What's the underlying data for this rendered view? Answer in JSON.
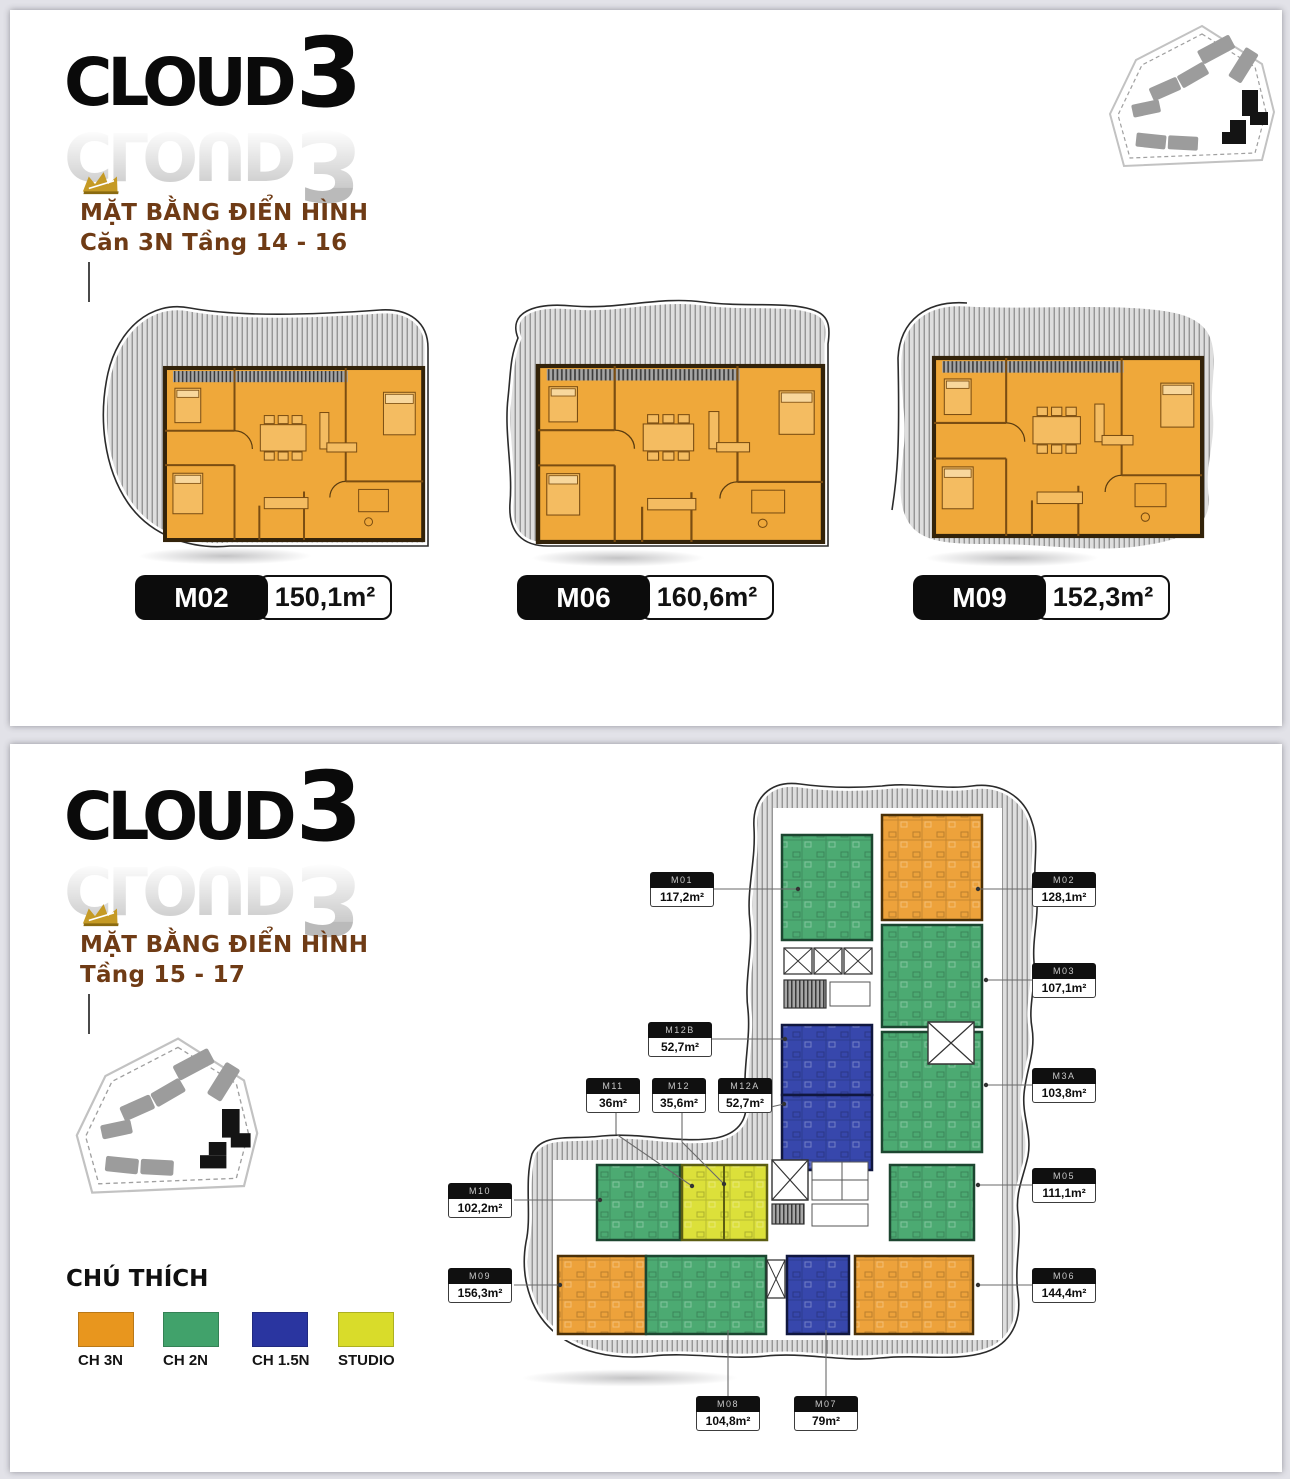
{
  "logo": {
    "word": "CLOUD",
    "digit": "3"
  },
  "top_panel": {
    "title_line1": "MẶT BẰNG ĐIỂN HÌNH",
    "title_line2": "Căn 3N Tầng 14 - 16",
    "plans": [
      {
        "id": "M02",
        "area": "150,1m²"
      },
      {
        "id": "M06",
        "area": "160,6m²"
      },
      {
        "id": "M09",
        "area": "152,3m²"
      }
    ]
  },
  "bottom_panel": {
    "title_line1": "MẶT BẰNG ĐIỂN HÌNH",
    "title_line2": "Tầng 15 - 17",
    "legend": {
      "title": "CHÚ THÍCH",
      "items": [
        {
          "label": "CH 3N",
          "color": "#E8961E"
        },
        {
          "label": "CH 2N",
          "color": "#41A26B"
        },
        {
          "label": "CH 1.5N",
          "color": "#2A35A0"
        },
        {
          "label": "STUDIO",
          "color": "#D9DC2A"
        }
      ]
    },
    "units": [
      {
        "id": "M01",
        "area": "117,2m²"
      },
      {
        "id": "M02",
        "area": "128,1m²"
      },
      {
        "id": "M03",
        "area": "107,1m²"
      },
      {
        "id": "M3A",
        "area": "103,8m²"
      },
      {
        "id": "M05",
        "area": "111,1m²"
      },
      {
        "id": "M06",
        "area": "144,4m²"
      },
      {
        "id": "M12B",
        "area": "52,7m²"
      },
      {
        "id": "M11",
        "area": "36m²"
      },
      {
        "id": "M12",
        "area": "35,6m²"
      },
      {
        "id": "M12A",
        "area": "52,7m²"
      },
      {
        "id": "M10",
        "area": "102,2m²"
      },
      {
        "id": "M09",
        "area": "156,3m²"
      },
      {
        "id": "M08",
        "area": "104,8m²"
      },
      {
        "id": "M07",
        "area": "79m²"
      }
    ]
  }
}
